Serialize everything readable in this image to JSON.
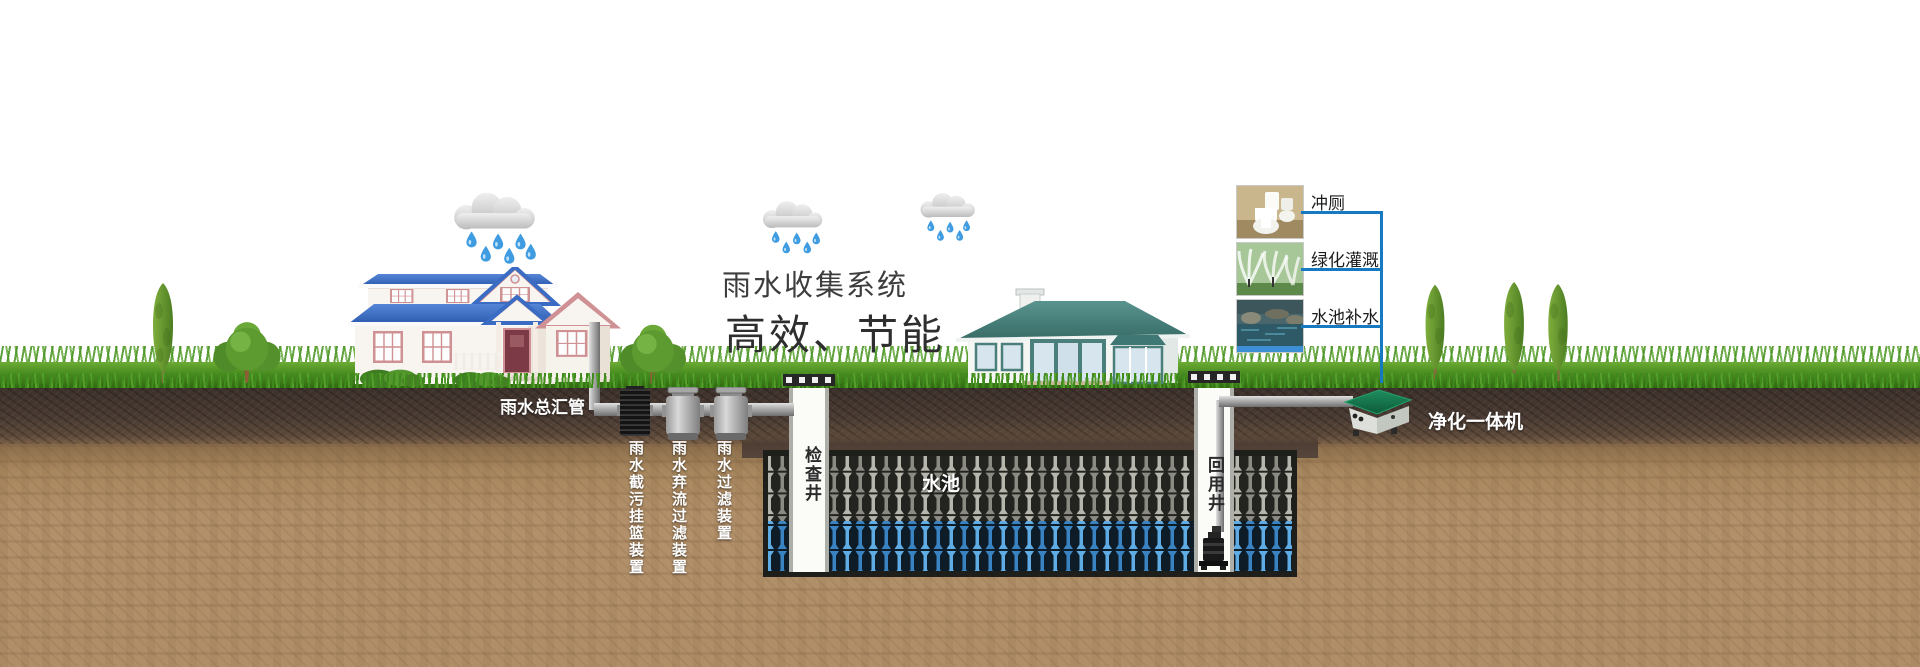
{
  "title": {
    "line1": "雨水收集系统",
    "line2": "高效、节能"
  },
  "labels": {
    "main_pipe": "雨水总汇管",
    "trash_basket_device": "雨水截污挂篮装置",
    "diversion_filter_device": "雨水弃流过滤装置",
    "filter_device": "雨水过滤装置",
    "inspection_well": "检查井",
    "water_tank": "水池",
    "reuse_well": "回用井",
    "purifier_unit": "净化一体机"
  },
  "reuse_items": [
    {
      "label": "冲厕",
      "photo": "toilet-photo"
    },
    {
      "label": "绿化灌溉",
      "photo": "irrigation-photo"
    },
    {
      "label": "水池补水",
      "photo": "pond-refill-photo"
    }
  ],
  "colors": {
    "connector_blue": "#1779c0",
    "tank_water_blue": "#5fabe4",
    "tank_module_gray": "#b6b6ad",
    "purifier_green": "#177a4f",
    "left_house_roof": "#3a70c8",
    "right_house_roof": "#46807c",
    "grass_green": "#4e9627",
    "topsoil_brown": "#463830",
    "subsoil_sand": "#b2906a"
  }
}
